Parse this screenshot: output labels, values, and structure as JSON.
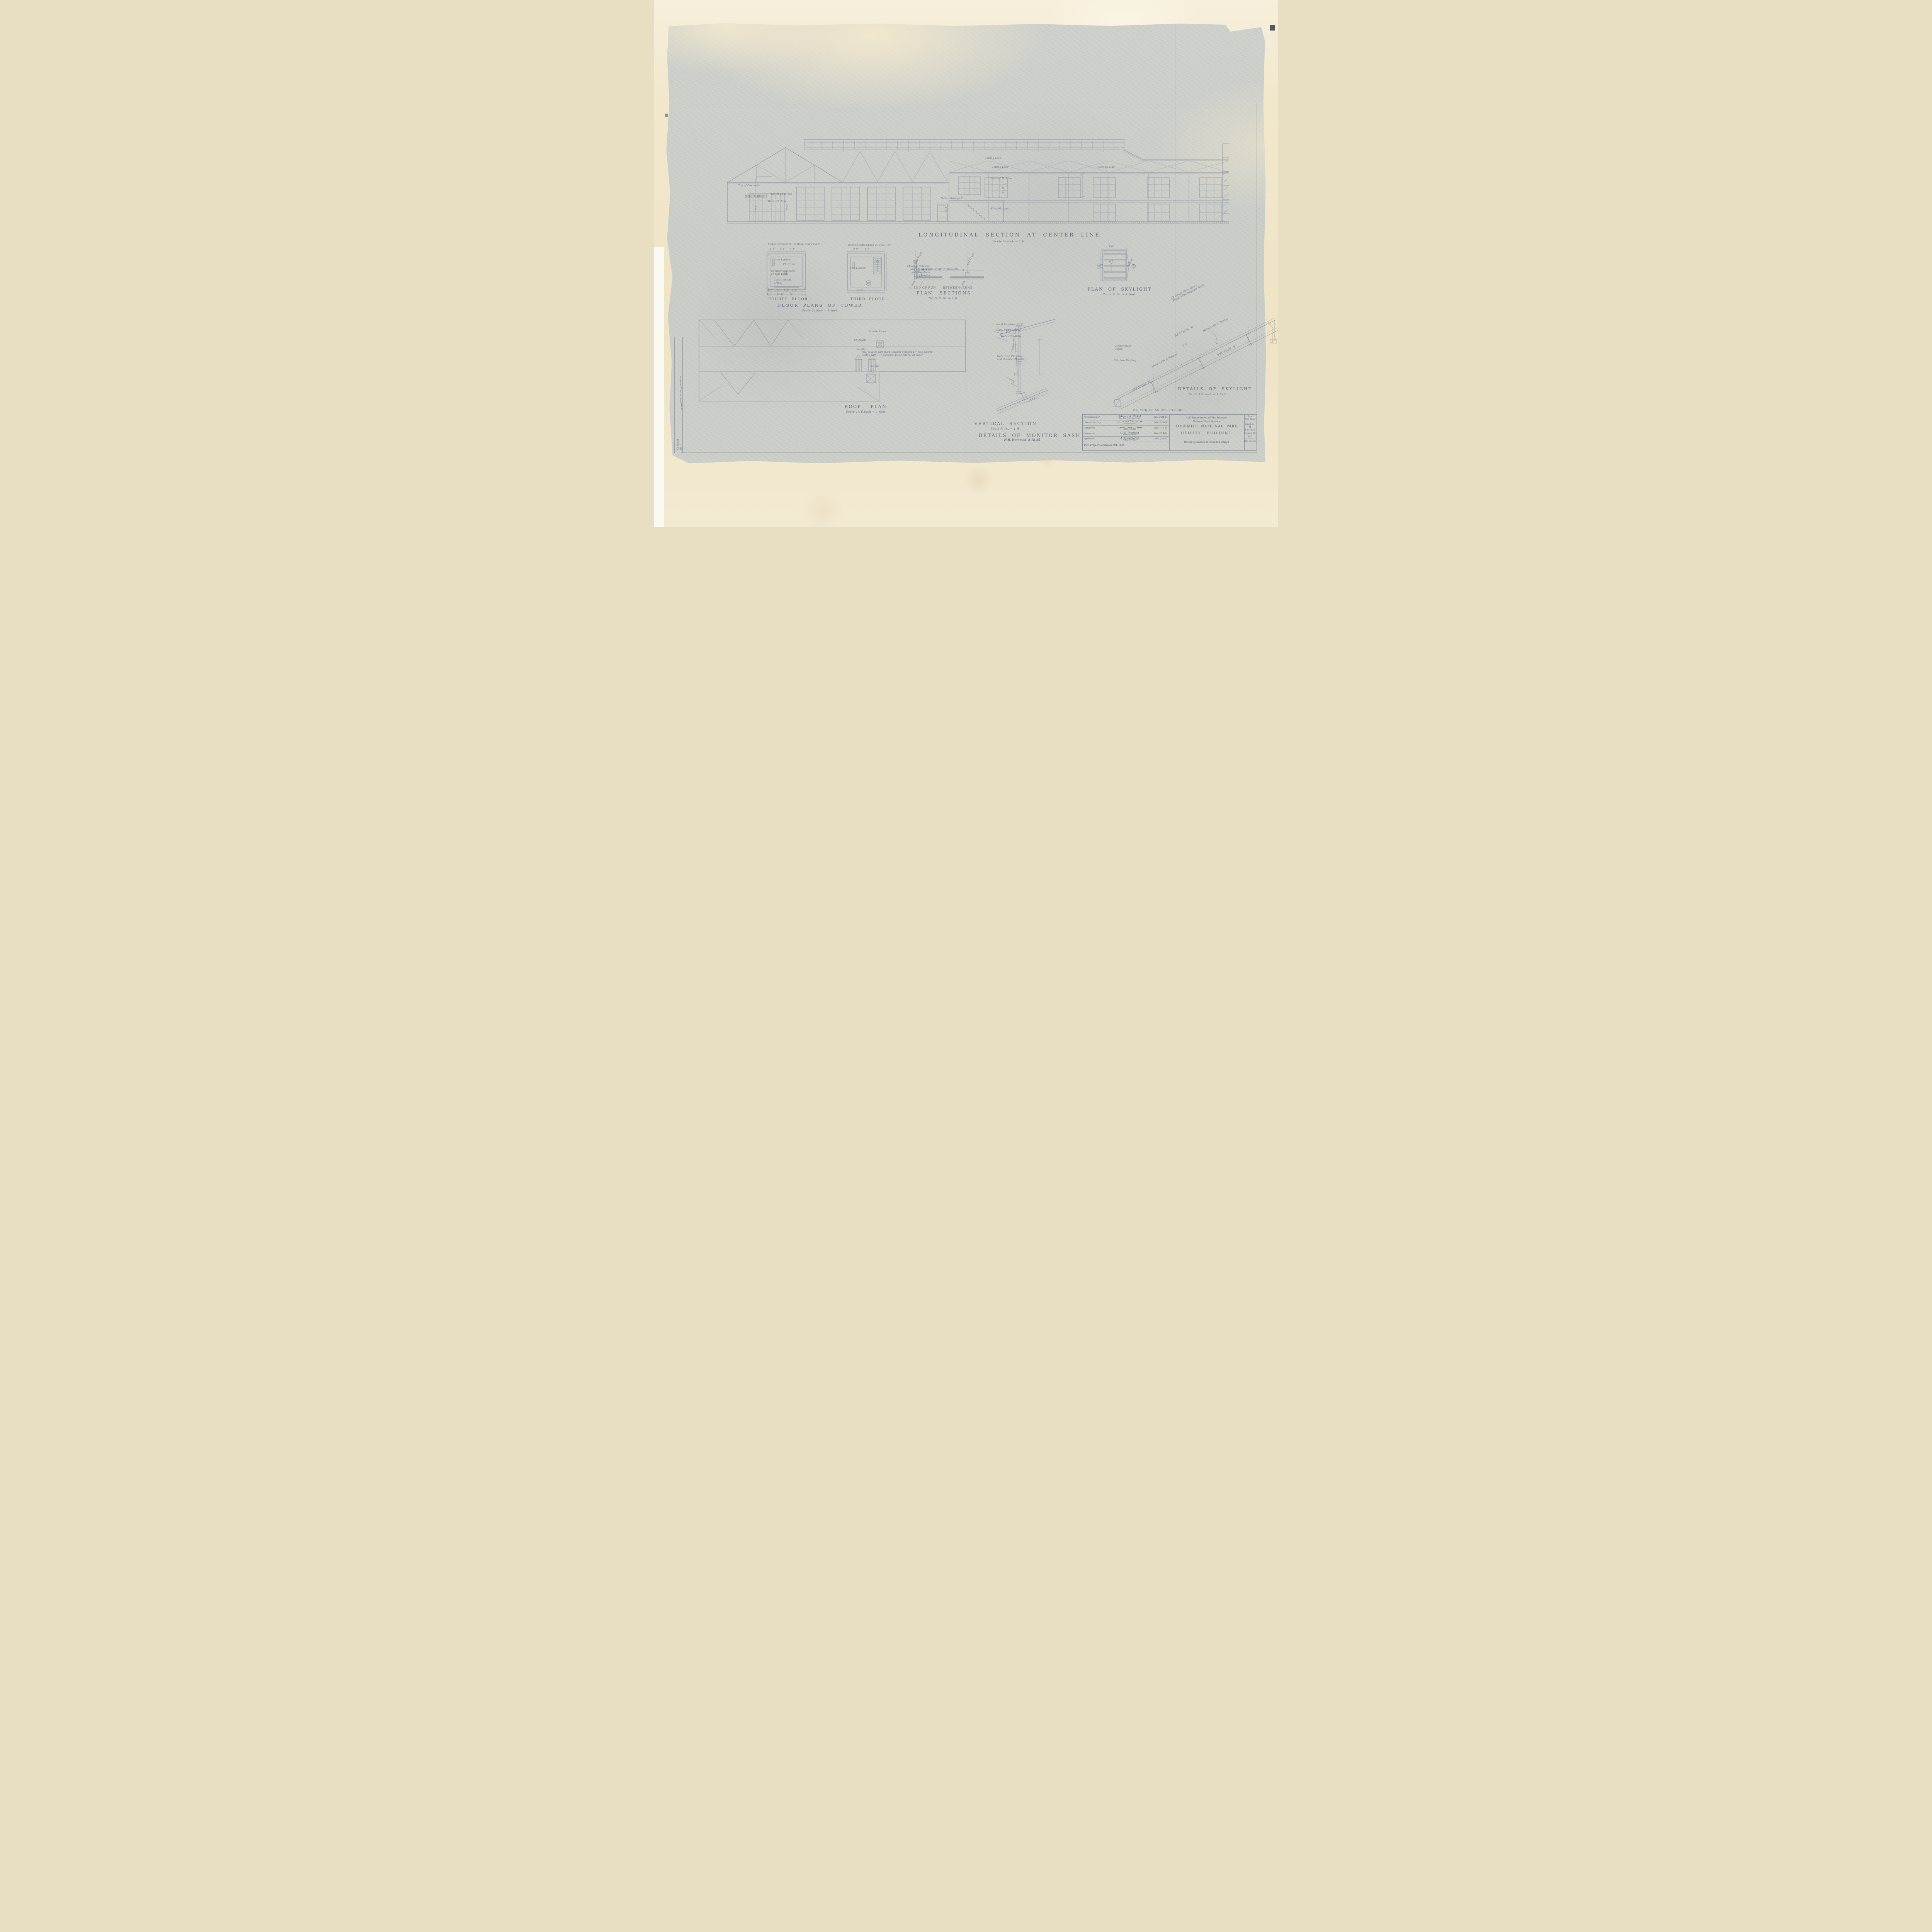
{
  "page": {
    "project_line": "P.W. PROJ.  F.P. NO. 303   PHYS. IMP.",
    "checked_by": "Checked By"
  },
  "long_section": {
    "title": "LONGITUDINAL  SECTION  AT  CENTER  LINE",
    "scale": "Scale ½ inch = 1 ft.",
    "labels": {
      "ceiling_line": "Ceiling Line",
      "second_floor": "Second Fl. Line",
      "first_floor": "First Fl. Line",
      "mezz_floor": "Mezz. Fl. Line",
      "mezz_storage": "Mezz. Storage Fl.",
      "top_of_concrete": "Top of Concrete",
      "motor_platform": "Motor Platform"
    },
    "dims": {
      "h15_2": "15'-2\"",
      "h12_6": "12'-6\"",
      "h13_6": "13'-6\"",
      "h10_6": "10'-6\""
    }
  },
  "tower_plans": {
    "title": "FLOOR  PLANS  OF  TOWER",
    "scale": "Scale ⅛ inch = 1 foot.",
    "fourth": {
      "name": "FOURTH  FLOOR",
      "door_note": "Metal Covered Dr. to Roof. 2'-6\"x3'-10\"",
      "dims_top": "6'-8\"      2'-4\"      6'-8\"",
      "dims_bottom_1": "4'-7\"    3'-3\"   3'-3\"    4'-7\"",
      "dims_bottom_2": "11\"        15'-8\"        11\"",
      "iron_ladder": "Iron Ladder",
      "floor_drain": "Fl. Drain",
      "deck_note": "Composition Roof\non this Deck",
      "grills_note": "Cast Cement\nGrills."
    },
    "third": {
      "name": "THIRD  FLOOR",
      "door_note": "Door to Attic Space 2'-6\"x3'-10\"",
      "dims_top": "8'-9\"        8'-9\"",
      "dim_bottom": "17'-6\"",
      "iron_ladder": "Iron Ladder",
      "detail_badge": "20"
    }
  },
  "roof_plan": {
    "title": "ROOF    PLAN",
    "scale": "Scale 1/16 inch = 1 foot",
    "covering_note": "Roof covered with Rigid Asbestos Shingles 17\" long, random\nwidths, with 7½\" exposure.  15 lb Slaters Felt under.",
    "labels": {
      "smoke_stack": "Smoke Stack",
      "skylights": "Skylights",
      "saddle": "Saddle"
    }
  },
  "plan_sections": {
    "title": "PLAN   SECTIONS",
    "scale": "Scale ¾ in. = 1 ft.",
    "end_of_run": "END OF RUN",
    "between_runs": "BETWEEN  RUNS",
    "cl_of_truss": "℄ of Truss",
    "g_iron": "G. Iron",
    "window_dim_1": "Window Dim. 14'-0\"",
    "mullion_dim": "12\"",
    "window_dim_2": "Window Dim.",
    "galv_note": "24 Gauge Galv. Iron\ncovering on ends\nand on mullions\nof Monitor"
  },
  "skylight_plan": {
    "title": "PLAN  OF  SKYLIGHT",
    "scale": "Scale ½ in. = 1 foot.",
    "dim": "5'-6\"",
    "saddle": "Saddle",
    "section_c": "C",
    "section_d": "D",
    "section_e": "E"
  },
  "monitor_detail": {
    "title": "VERTICAL  SECTION",
    "scale": "Scale ¾ in. = 1 ft.",
    "subtitle": "DETAILS  OF  MONITOR  SASH",
    "signature": "H.B. Hommon  5-18-34",
    "labels": {
      "wood_blocking": "Wood Blocking 12\"C.",
      "cornice": "Galv. Iron Cornice",
      "drip": "Galv. Iron Drip",
      "window_dim": "Window Dim. 3'-6\"",
      "flashing": "Galv. Iron Flashing\nand Counter-Flashing"
    }
  },
  "skylight_details": {
    "title": "DETAILS  OF  SKYLIGHT",
    "scale": "Scale 1½ inch = 1 foot",
    "section_c": "SECTION  C",
    "section_d": "SECTION  D",
    "section_e": "SECTION  E",
    "dim": "5'-6\"",
    "metal_lath": "Metal Lath & Plaster",
    "glass_note": "22 Gauge Galv. Iron –\nRough Wire Skylight Glass",
    "flashing": "Galv. Iron Flashing",
    "gutter": "Condensation\nGutter"
  },
  "title_block": {
    "rows": [
      {
        "action": "Recommended",
        "name": "Edward A. Nickel",
        "role": "For The Chief Architect",
        "date": "Date 5-25-34"
      },
      {
        "action": "Cleared for Eng.",
        "name": "",
        "role": "Chief Engineer",
        "date": "Date 5-26-34"
      },
      {
        "action": "Concurred",
        "name": "",
        "role": "Chief Forester",
        "date": "Date 7-17-34"
      },
      {
        "action": "Concurred",
        "name": "C. G. Thomson",
        "role": "Superintendent",
        "date": "Date 5/14/34"
      },
      {
        "action": "Approved",
        "name": "A. E. Demaray",
        "role": "Acting Director",
        "date": "Date 7/21/34"
      }
    ],
    "completed_note": "PWA Project Completed Oct. 1935",
    "agency_line_1": "U.S. Department of The Interior",
    "agency_line_2": "National Park Service",
    "park_name": "YOSEMITE  NATIONAL  PARK",
    "sheet_title": "UTILITY   BUILDING",
    "drawn_by": "Drawn By Branch of Plans and Design",
    "date_label": "Date",
    "date_value": "Nov. 18/33",
    "sheet_label": "Sheet No.",
    "sheet_number": "6",
    "sheet_of": "of 33 Sheets",
    "drawing_label": "Drawing No.",
    "drawing_prefix": "N.P.",
    "drawing_value": "YOS 3012 M."
  }
}
